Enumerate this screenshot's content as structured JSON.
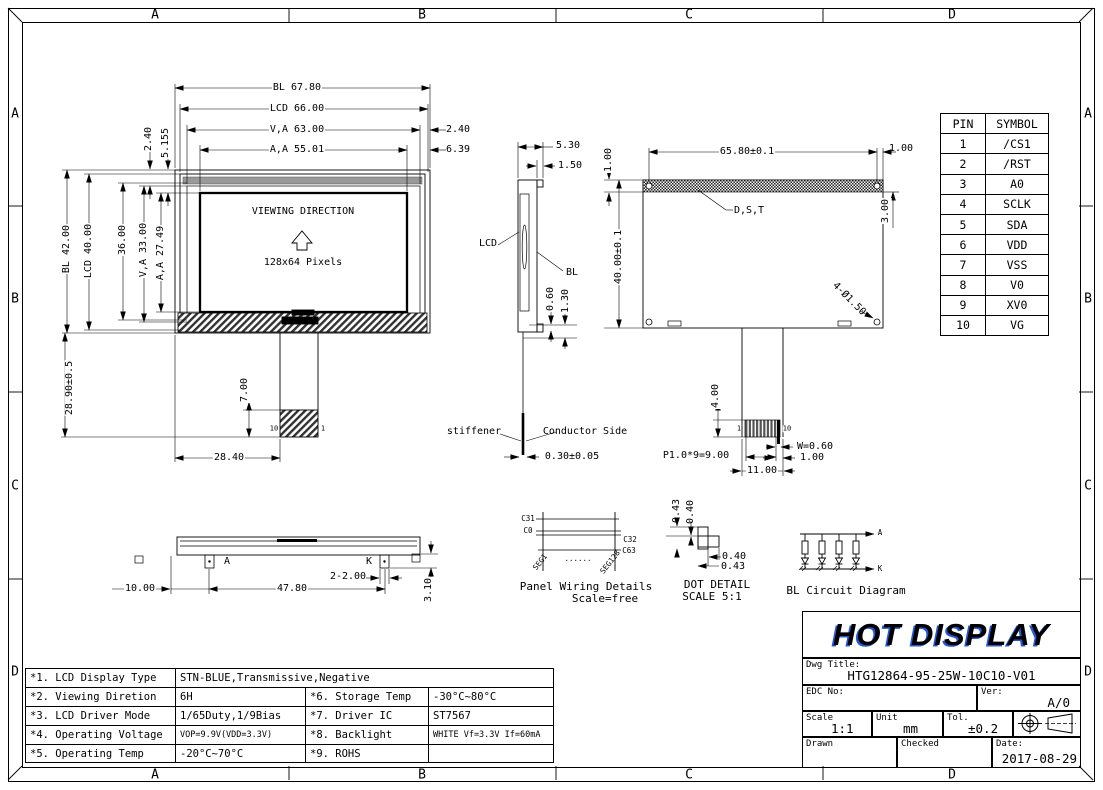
{
  "border": {
    "top_zones": [
      "A",
      "B",
      "C",
      "D"
    ],
    "bottom_zones": [
      "A",
      "B",
      "C",
      "D"
    ],
    "left_zones": [
      "A",
      "B",
      "C",
      "D"
    ],
    "right_zones": [
      "A",
      "B",
      "C",
      "D"
    ]
  },
  "front_view": {
    "dim_bl_width": "BL 67.80",
    "dim_lcd_width": "LCD 66.00",
    "dim_va_width": "V,A 63.00",
    "dim_va_offset": "2.40",
    "dim_aa_width": "A,A 55.01",
    "dim_aa_offset": "6.39",
    "dim_topleft_1": "2.40",
    "dim_topleft_2": "5.155",
    "dim_bl_height": "BL 42.00",
    "dim_lcd_height": "LCD 40.00",
    "dim_36": "36.00",
    "dim_va_height": "V,A 33.00",
    "dim_aa_height": "A,A 27.49",
    "screen_line1": "VIEWING DIRECTION",
    "screen_line2": "128x64 Pixels",
    "dim_tail": "28.90±0.5",
    "dim_connector": "7.00",
    "dim_tail_offset": "28.40",
    "pin_left": "10",
    "pin_right": "1"
  },
  "side_view": {
    "dim_thickness": "5.30",
    "dim_bl_thickness": "1.50",
    "label_lcd": "LCD",
    "label_bl": "BL",
    "dim_060": "0.60",
    "dim_130": "1.30",
    "label_stiffener": "stiffener",
    "label_conductor": "Conductor Side",
    "dim_fpc": "0.30±0.05"
  },
  "rear_view": {
    "dim_width": "65.80±0.1",
    "dim_left_100": "1.00",
    "dim_right_100": "1.00",
    "dim_300": "3.00",
    "dim_height": "40.00±0.1",
    "label_dst": "D,S,T",
    "label_holes": "4-Ø1.50",
    "dim_400": "4.00",
    "pin_left": "1",
    "pin_right": "10",
    "dim_pin_width": "W=0.60",
    "dim_pin_100": "1.00",
    "dim_pitch": "P1.0*9=9.00",
    "dim_1100": "11.00"
  },
  "bottom_view": {
    "label_anode": "A",
    "label_cathode": "K",
    "dim_1000": "10.00",
    "dim_4780": "47.80",
    "dim_2200": "2-2.00",
    "dim_310": "3.10"
  },
  "pin_table": {
    "headers": [
      "PIN",
      "SYMBOL"
    ],
    "rows": [
      {
        "pin": "1",
        "symbol": "/CS1"
      },
      {
        "pin": "2",
        "symbol": "/RST"
      },
      {
        "pin": "3",
        "symbol": "A0"
      },
      {
        "pin": "4",
        "symbol": "SCLK"
      },
      {
        "pin": "5",
        "symbol": "SDA"
      },
      {
        "pin": "6",
        "symbol": "VDD"
      },
      {
        "pin": "7",
        "symbol": "VSS"
      },
      {
        "pin": "8",
        "symbol": "V0"
      },
      {
        "pin": "9",
        "symbol": "XV0"
      },
      {
        "pin": "10",
        "symbol": "VG"
      }
    ]
  },
  "panel_wiring": {
    "label_c31": "C31",
    "label_c0": "C0",
    "label_c32": "C32",
    "label_c63": "C63",
    "label_seg1": "SEG1",
    "label_seg128": "SEG128",
    "dots": "......",
    "caption1": "Panel Wiring Details",
    "caption2": "Scale=free"
  },
  "dot_detail": {
    "dim_v_043": "0.43",
    "dim_v_040": "0.40",
    "dim_h_040": "0.40",
    "dim_h_043": "0.43",
    "caption1": "DOT DETAIL",
    "caption2": "SCALE 5:1"
  },
  "bl_circuit": {
    "label_anode": "A",
    "label_cathode": "K",
    "caption": "BL Circuit Diagram"
  },
  "spec_table": {
    "row1": {
      "label": "*1. LCD Display Type",
      "value": "STN-BLUE,Transmissive,Negative"
    },
    "row2": {
      "label": "*2. Viewing Diretion",
      "value": "6H",
      "label2": "*6. Storage Temp",
      "value2": "-30°C~80°C"
    },
    "row3": {
      "label": "*3. LCD Driver Mode",
      "value": "1/65Duty,1/9Bias",
      "label2": "*7. Driver IC",
      "value2": "ST7567"
    },
    "row4": {
      "label": "*4. Operating Voltage",
      "value": "VOP=9.9V(VDD=3.3V)",
      "label2": "*8. Backlight",
      "value2": "WHITE Vf=3.3V If=60mA"
    },
    "row5": {
      "label": "*5. Operating Temp",
      "value": "-20°C~70°C",
      "label2": "*9. ROHS",
      "value2": ""
    }
  },
  "title_block": {
    "logo": "HOT DISPLAY",
    "dwg_title_label": "Dwg Title:",
    "dwg_title": "HTG12864-95-25W-10C10-V01",
    "edc_label": "EDC No:",
    "ver_label": "Ver:",
    "ver": "A/0",
    "scale_label": "Scale",
    "scale": "1:1",
    "unit_label": "Unit",
    "unit": "mm",
    "tol_label": "Tol.",
    "tol": "±0.2",
    "drawn_label": "Drawn",
    "checked_label": "Checked",
    "date_label": "Date:",
    "date": "2017-08-29"
  },
  "colors": {
    "line": "#000000",
    "logo_shadow": "#2457d6",
    "hatch": "#333333"
  }
}
